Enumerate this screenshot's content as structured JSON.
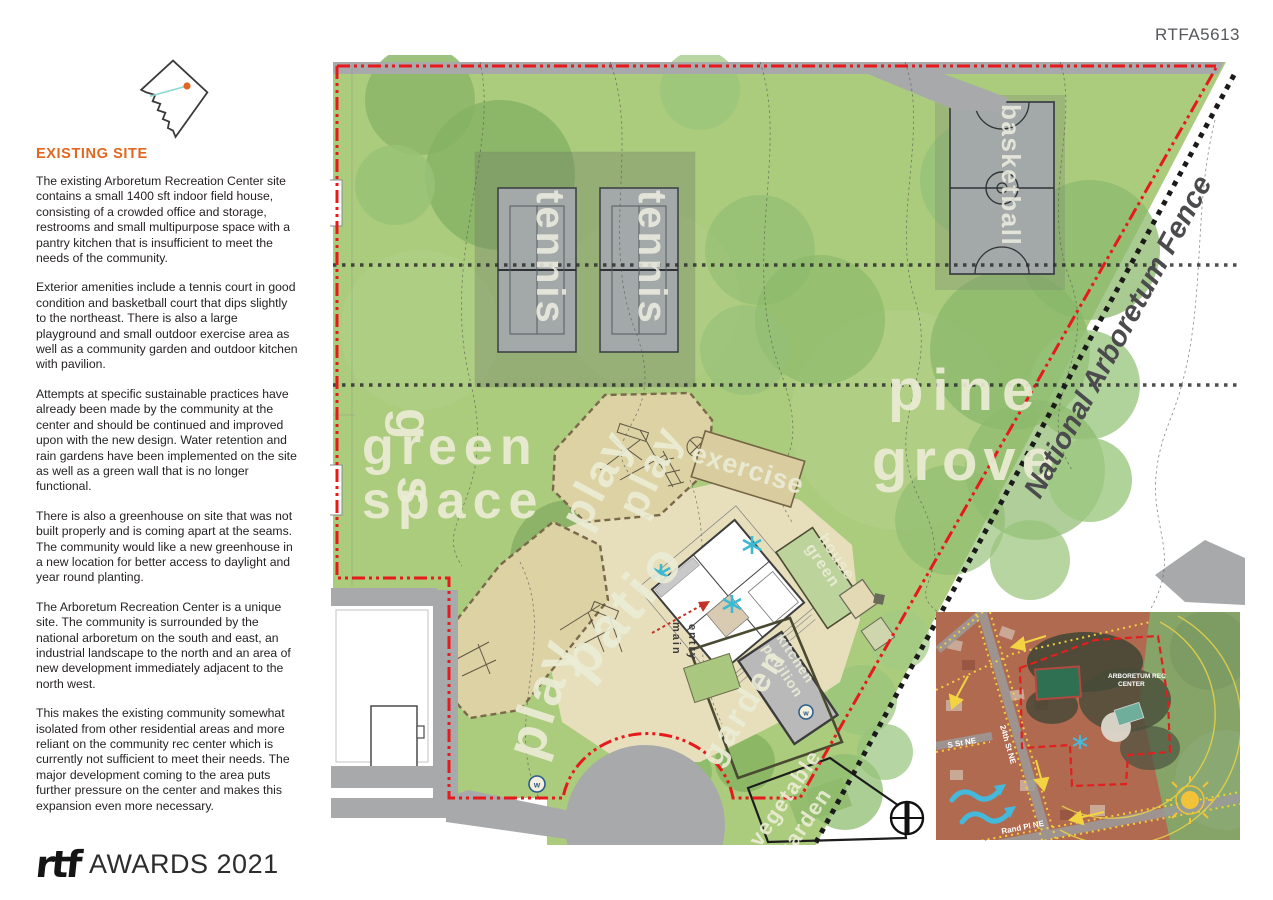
{
  "page": {
    "code": "RTFA5613"
  },
  "sidebar": {
    "heading": "EXISTING SITE",
    "paragraphs": [
      "The existing Arboretum Recreation Center site contains a small 1400 sft indoor field house, consisting of a crowded office and storage, restrooms and small multipurpose space with a pantry kitchen that is insufficient to meet the needs of the community.",
      "Exterior amenities include a tennis court in good condition and basketball court that dips slightly to the northeast. There is also a large playground and small outdoor exercise area as well as a community garden and outdoor kitchen with pavilion.",
      "Attempts at specific sustainable practices have already been made by the community at the center and should be continued and improved upon with the new design. Water retention and rain gardens have been implemented on the site as well as a green wall that is no longer functional.",
      "There is also a greenhouse on site that was not built properly and is coming apart at the seams. The community would like a new greenhouse in a new location for better access to daylight and year round planting.",
      "The Arboretum Recreation Center is a unique site. The community is surrounded by the national arboretum on the south and east, an industrial landscape to the north and an area of new development immediately adjacent to the north west.",
      "This makes the existing community somewhat isolated from other residential areas and more reliant on the community  rec center which is currently not sufficient to meet their needs. The major development coming to the area puts further pressure on the center and makes this expansion even more necessary."
    ],
    "footer": {
      "logo_text": "rtf",
      "awards_text": "AWARDS 2021"
    }
  },
  "plan": {
    "labels": {
      "tennis": "tennis",
      "basketball": "basketball",
      "pine": "pine",
      "grove": "grove",
      "green": "green",
      "space": "space",
      "green_vert_g": "g",
      "green_vert_s": "s",
      "play": "play",
      "patio": "patio",
      "exercise": "exercise",
      "main": "main",
      "entry": "entry",
      "greenhouse_line1": "green",
      "greenhouse_line2": "house",
      "pavilion_line1": "pavilion",
      "pavilion_line2": "kitchen",
      "garden": "garden",
      "veg_line1": "vegetable",
      "veg_line2": "garden",
      "fence": "National Arboretum Fence",
      "water_symbol": "w"
    },
    "colors": {
      "site_green": "#abcb7d",
      "boundary_red": "#e8191c",
      "fence_black": "#1a1a1a",
      "court_gray": "#a3a8a8",
      "playground_tan": "#ddd2a4",
      "label_cream": "#eaebd5",
      "accent_orange": "#e2661f",
      "tree_cyan": "#3ab9d1"
    }
  },
  "inset": {
    "site_label_line1": "ARBORETUM REC",
    "site_label_line2": "CENTER",
    "streets": [
      "S St NE",
      "24th St NE",
      "Rand Pl NE"
    ]
  }
}
